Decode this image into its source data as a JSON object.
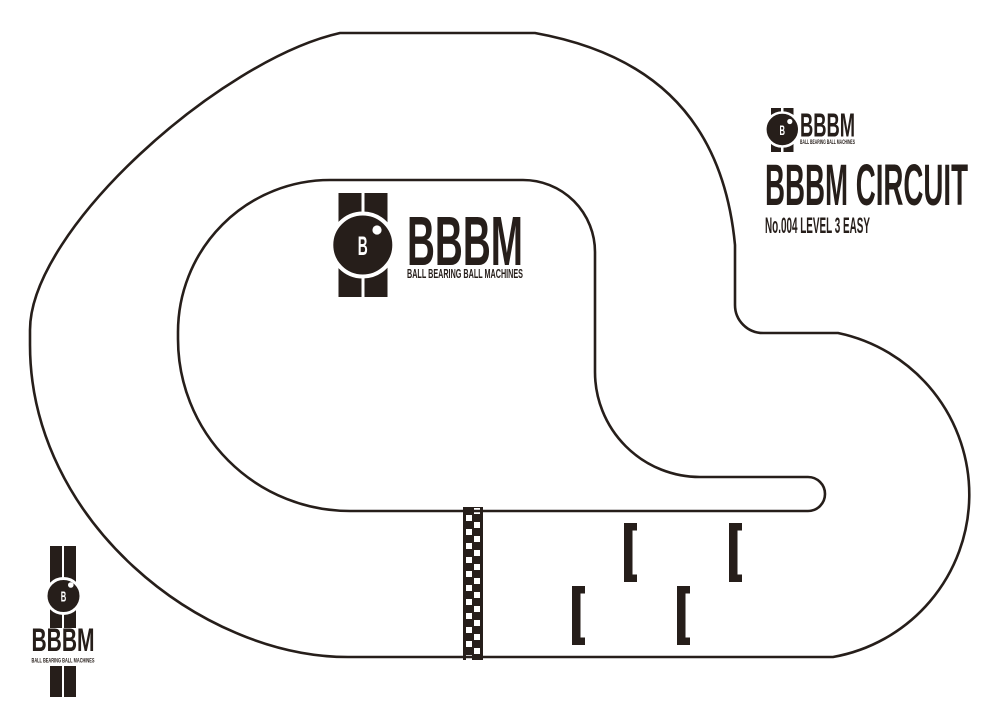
{
  "colors": {
    "ink": "#261e1a",
    "paper": "#ffffff"
  },
  "header": {
    "title": "BBBM CIRCUIT",
    "subtitle": "No.004 LEVEL 3 EASY",
    "number": "No.004",
    "level": "LEVEL 3 EASY"
  },
  "brand": {
    "name": "BBBM",
    "tagline": "BALL BEARING BALL MACHINES",
    "monogram": "B"
  },
  "track": {
    "grid_slots": 4,
    "has_start_finish_line": true
  }
}
